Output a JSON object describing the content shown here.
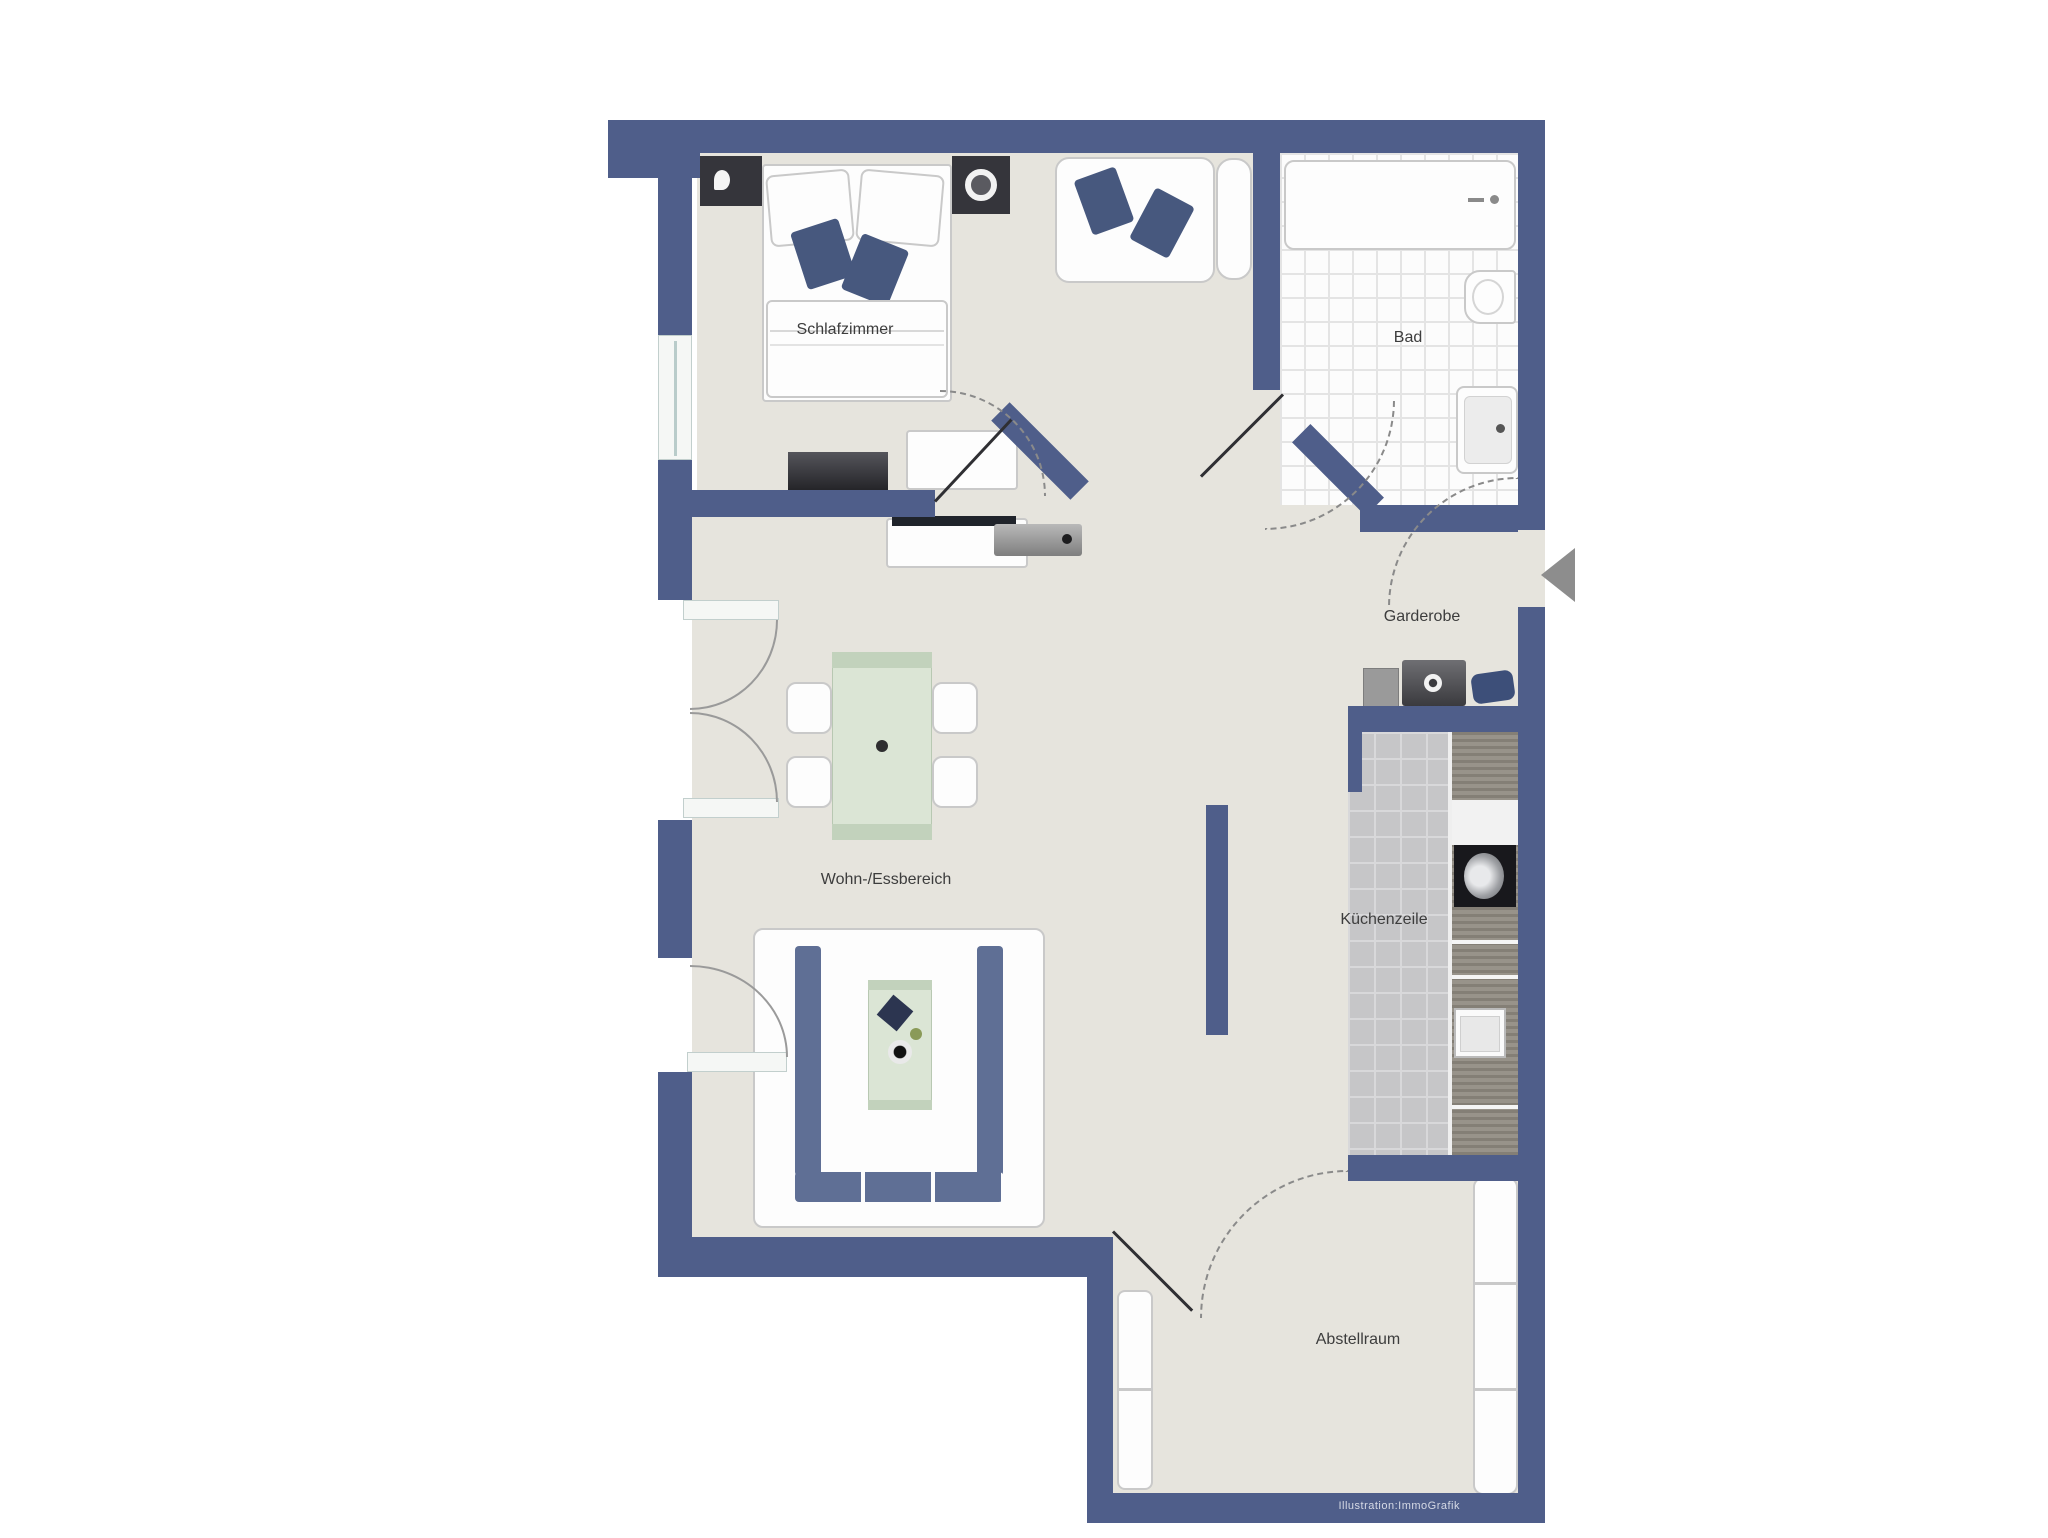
{
  "plan": {
    "type": "apartment-floor-plan",
    "rooms": [
      {
        "id": "bedroom",
        "label": "Schlafzimmer"
      },
      {
        "id": "bathroom",
        "label": "Bad"
      },
      {
        "id": "wardrobe",
        "label": "Garderobe"
      },
      {
        "id": "living_dining",
        "label": "Wohn-/Essbereich"
      },
      {
        "id": "kitchenette",
        "label": "Küchenzeile"
      },
      {
        "id": "storage",
        "label": "Abstellraum"
      }
    ],
    "credit": "Illustration:ImmoGrafik",
    "colors": {
      "wall": "#4f5e8a",
      "floor": "#e6e4dd",
      "bath_tile_grid": "#e4e4e4",
      "kitchen_tile": "#c6c6c8",
      "accent_pillow": "#47587e",
      "sofa_cushion": "#5f6f95",
      "table_green": "#dbe5d5",
      "entry_arrow": "#8d8d8d",
      "furniture_white": "#fdfdfd",
      "furniture_dark": "#35353b"
    }
  }
}
